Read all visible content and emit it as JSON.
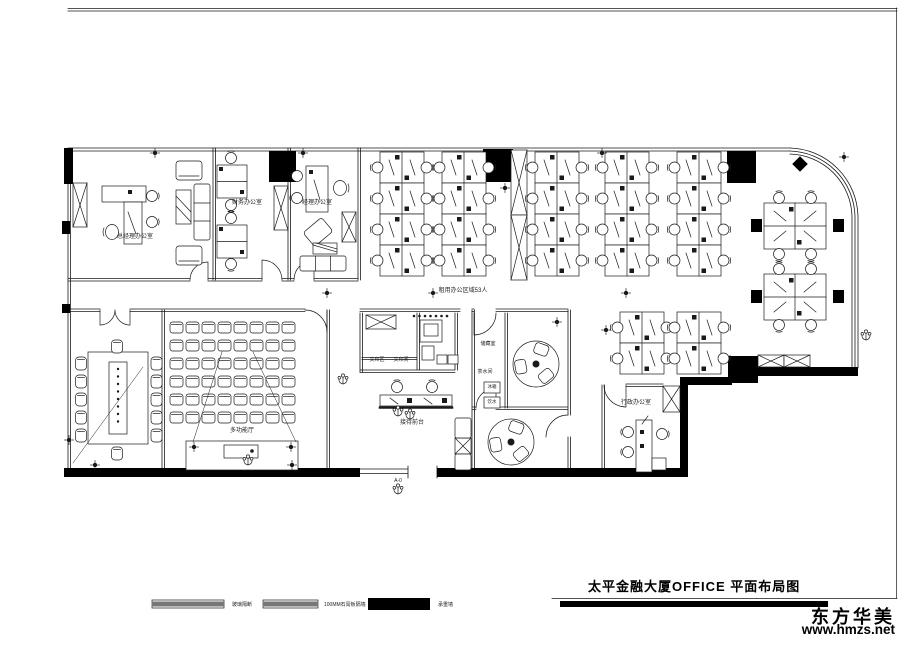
{
  "meta": {
    "drawing_title": "太平金融大厦OFFICE  平面布局图"
  },
  "watermark": {
    "brand": "东方华美",
    "site": "www.hmzs.net"
  },
  "legend": {
    "items": [
      {
        "label": "玻璃隔断",
        "style": "dashed"
      },
      {
        "label": "100MM石膏板隔墙",
        "style": "dashed"
      },
      {
        "label": "承重墙",
        "style": "solid"
      }
    ]
  },
  "labels": {
    "gm_office": "总经理办公室",
    "finance_office": "财务办公室",
    "manager_office": "经理办公室",
    "open_area": "租用办公区域53人",
    "multi_hall": "多功能厅",
    "copy_area": "文印区",
    "copy_room": "文印间",
    "reception": "接待前台",
    "storage": "储藏室",
    "pantry": "茶水间",
    "fridge": "冰箱",
    "water": "饮水",
    "admin_office": "行政办公室",
    "entrance": "A-0"
  },
  "colors": {
    "ink": "#1a1a1a",
    "paper": "#ffffff",
    "wall": "#000000"
  }
}
